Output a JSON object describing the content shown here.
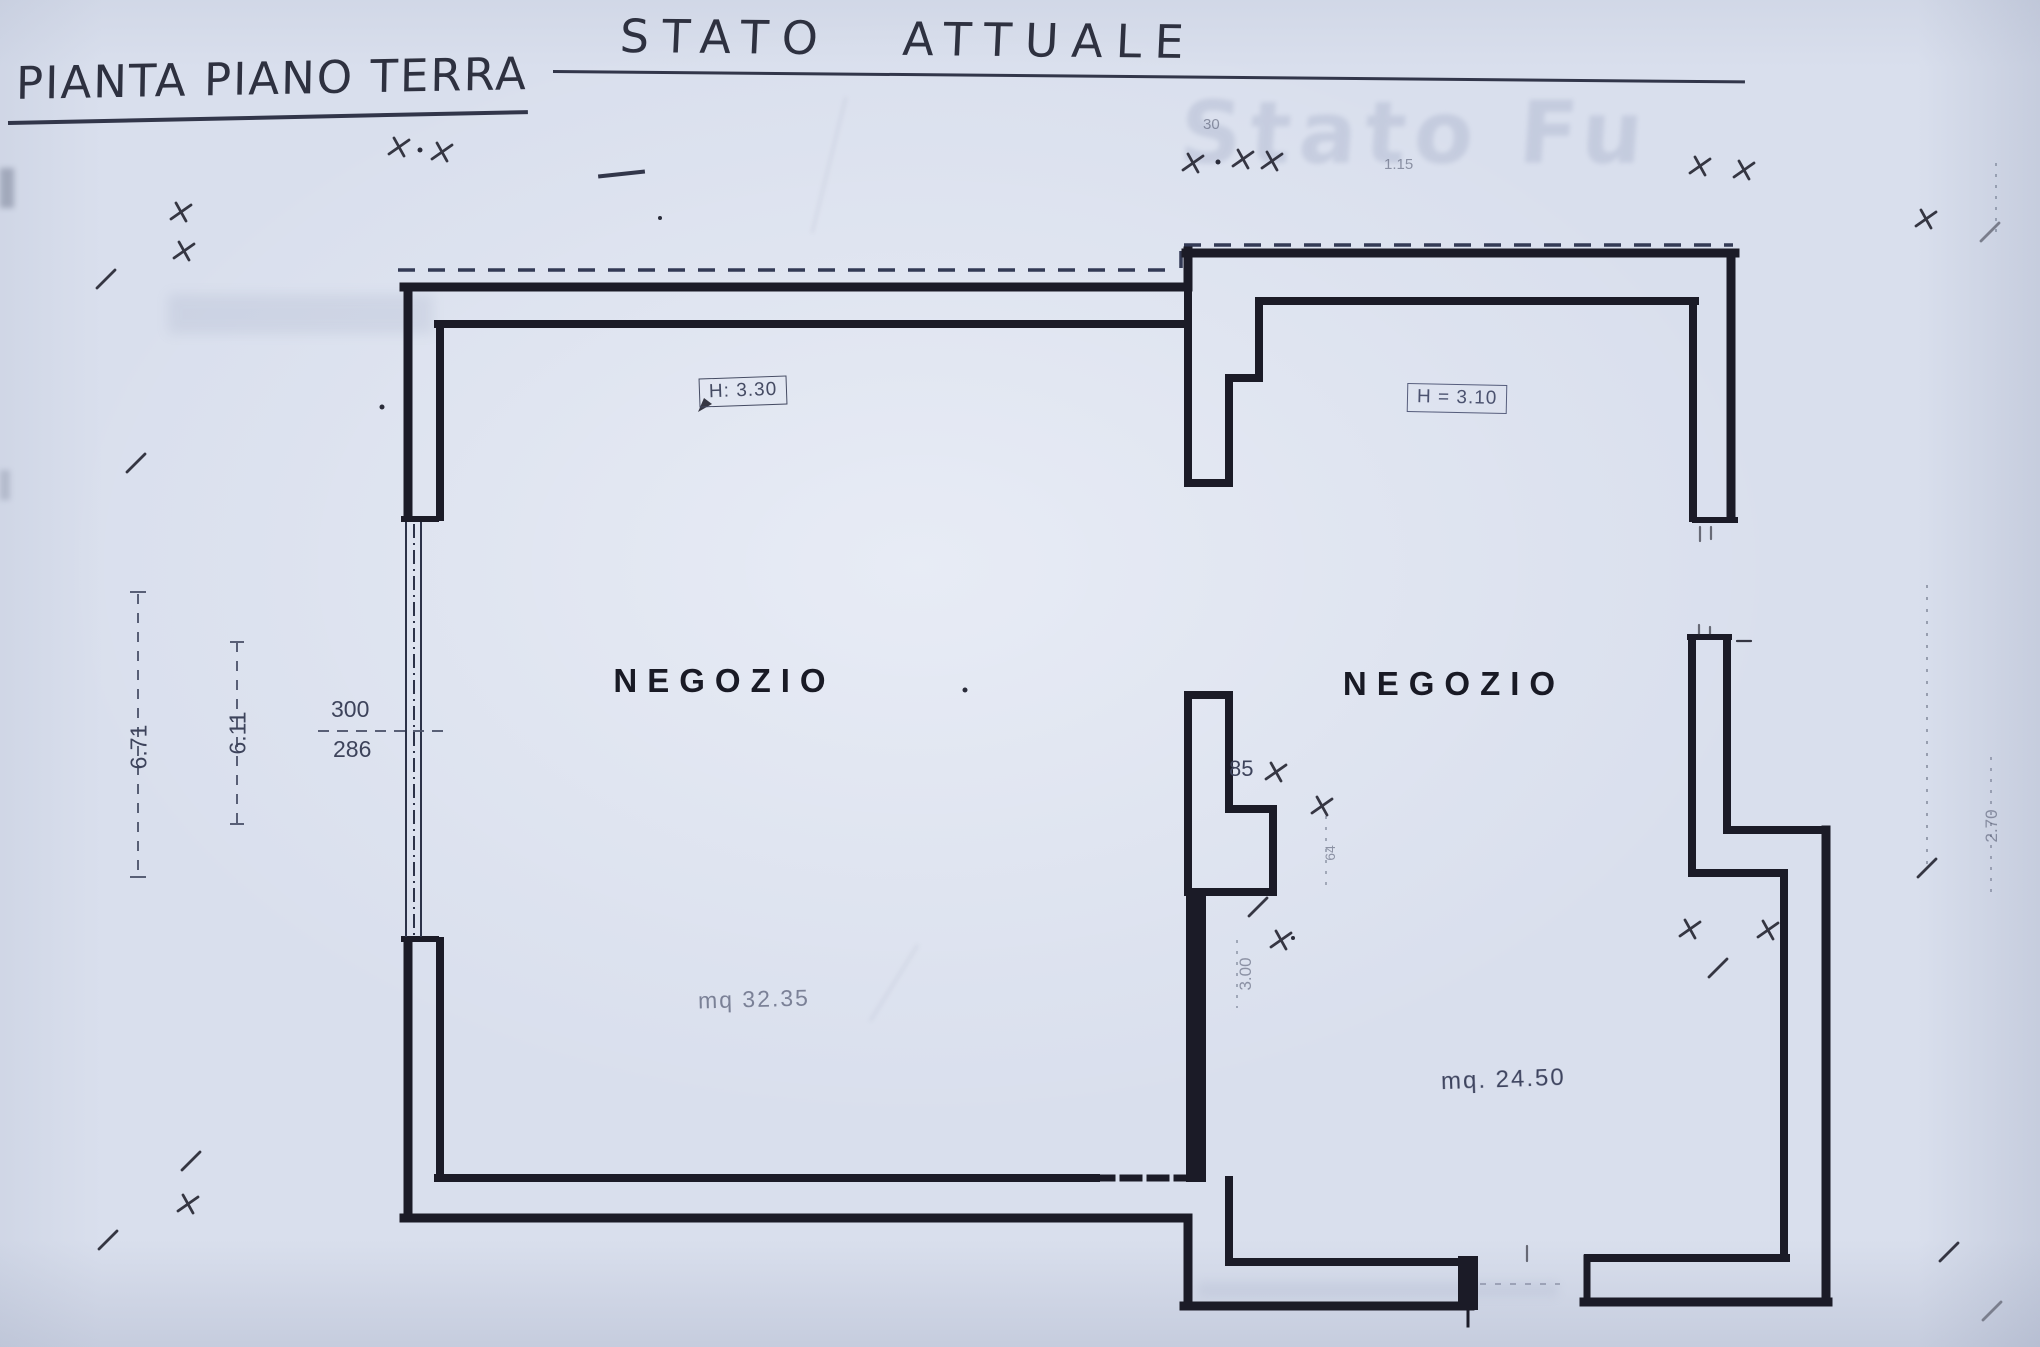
{
  "titles": {
    "plan": "PIANTA PIANO TERRA",
    "state": "STATO ATTUALE"
  },
  "rooms": {
    "left": {
      "name": "NEGOZIO",
      "area": "mq 32.35",
      "height": "H: 3.30"
    },
    "right": {
      "name": "NEGOZIO",
      "area": "mq. 24.50",
      "height": "H = 3.10"
    }
  },
  "dimensions": {
    "outer_width": "6.71",
    "inner_width": "6.11",
    "opening_upper": "300",
    "opening_lower": "286",
    "niche": "85",
    "right_side": "2.70",
    "wall_segment": "3.00",
    "step_right": "64",
    "faint_a": "30",
    "faint_b": "1.15"
  },
  "bleed_through": {
    "next_sheet_title": "Stato Fu"
  },
  "colors": {
    "paper": "#d9dfed",
    "ink": "#1b1b27",
    "pencil": "#4a5168"
  }
}
